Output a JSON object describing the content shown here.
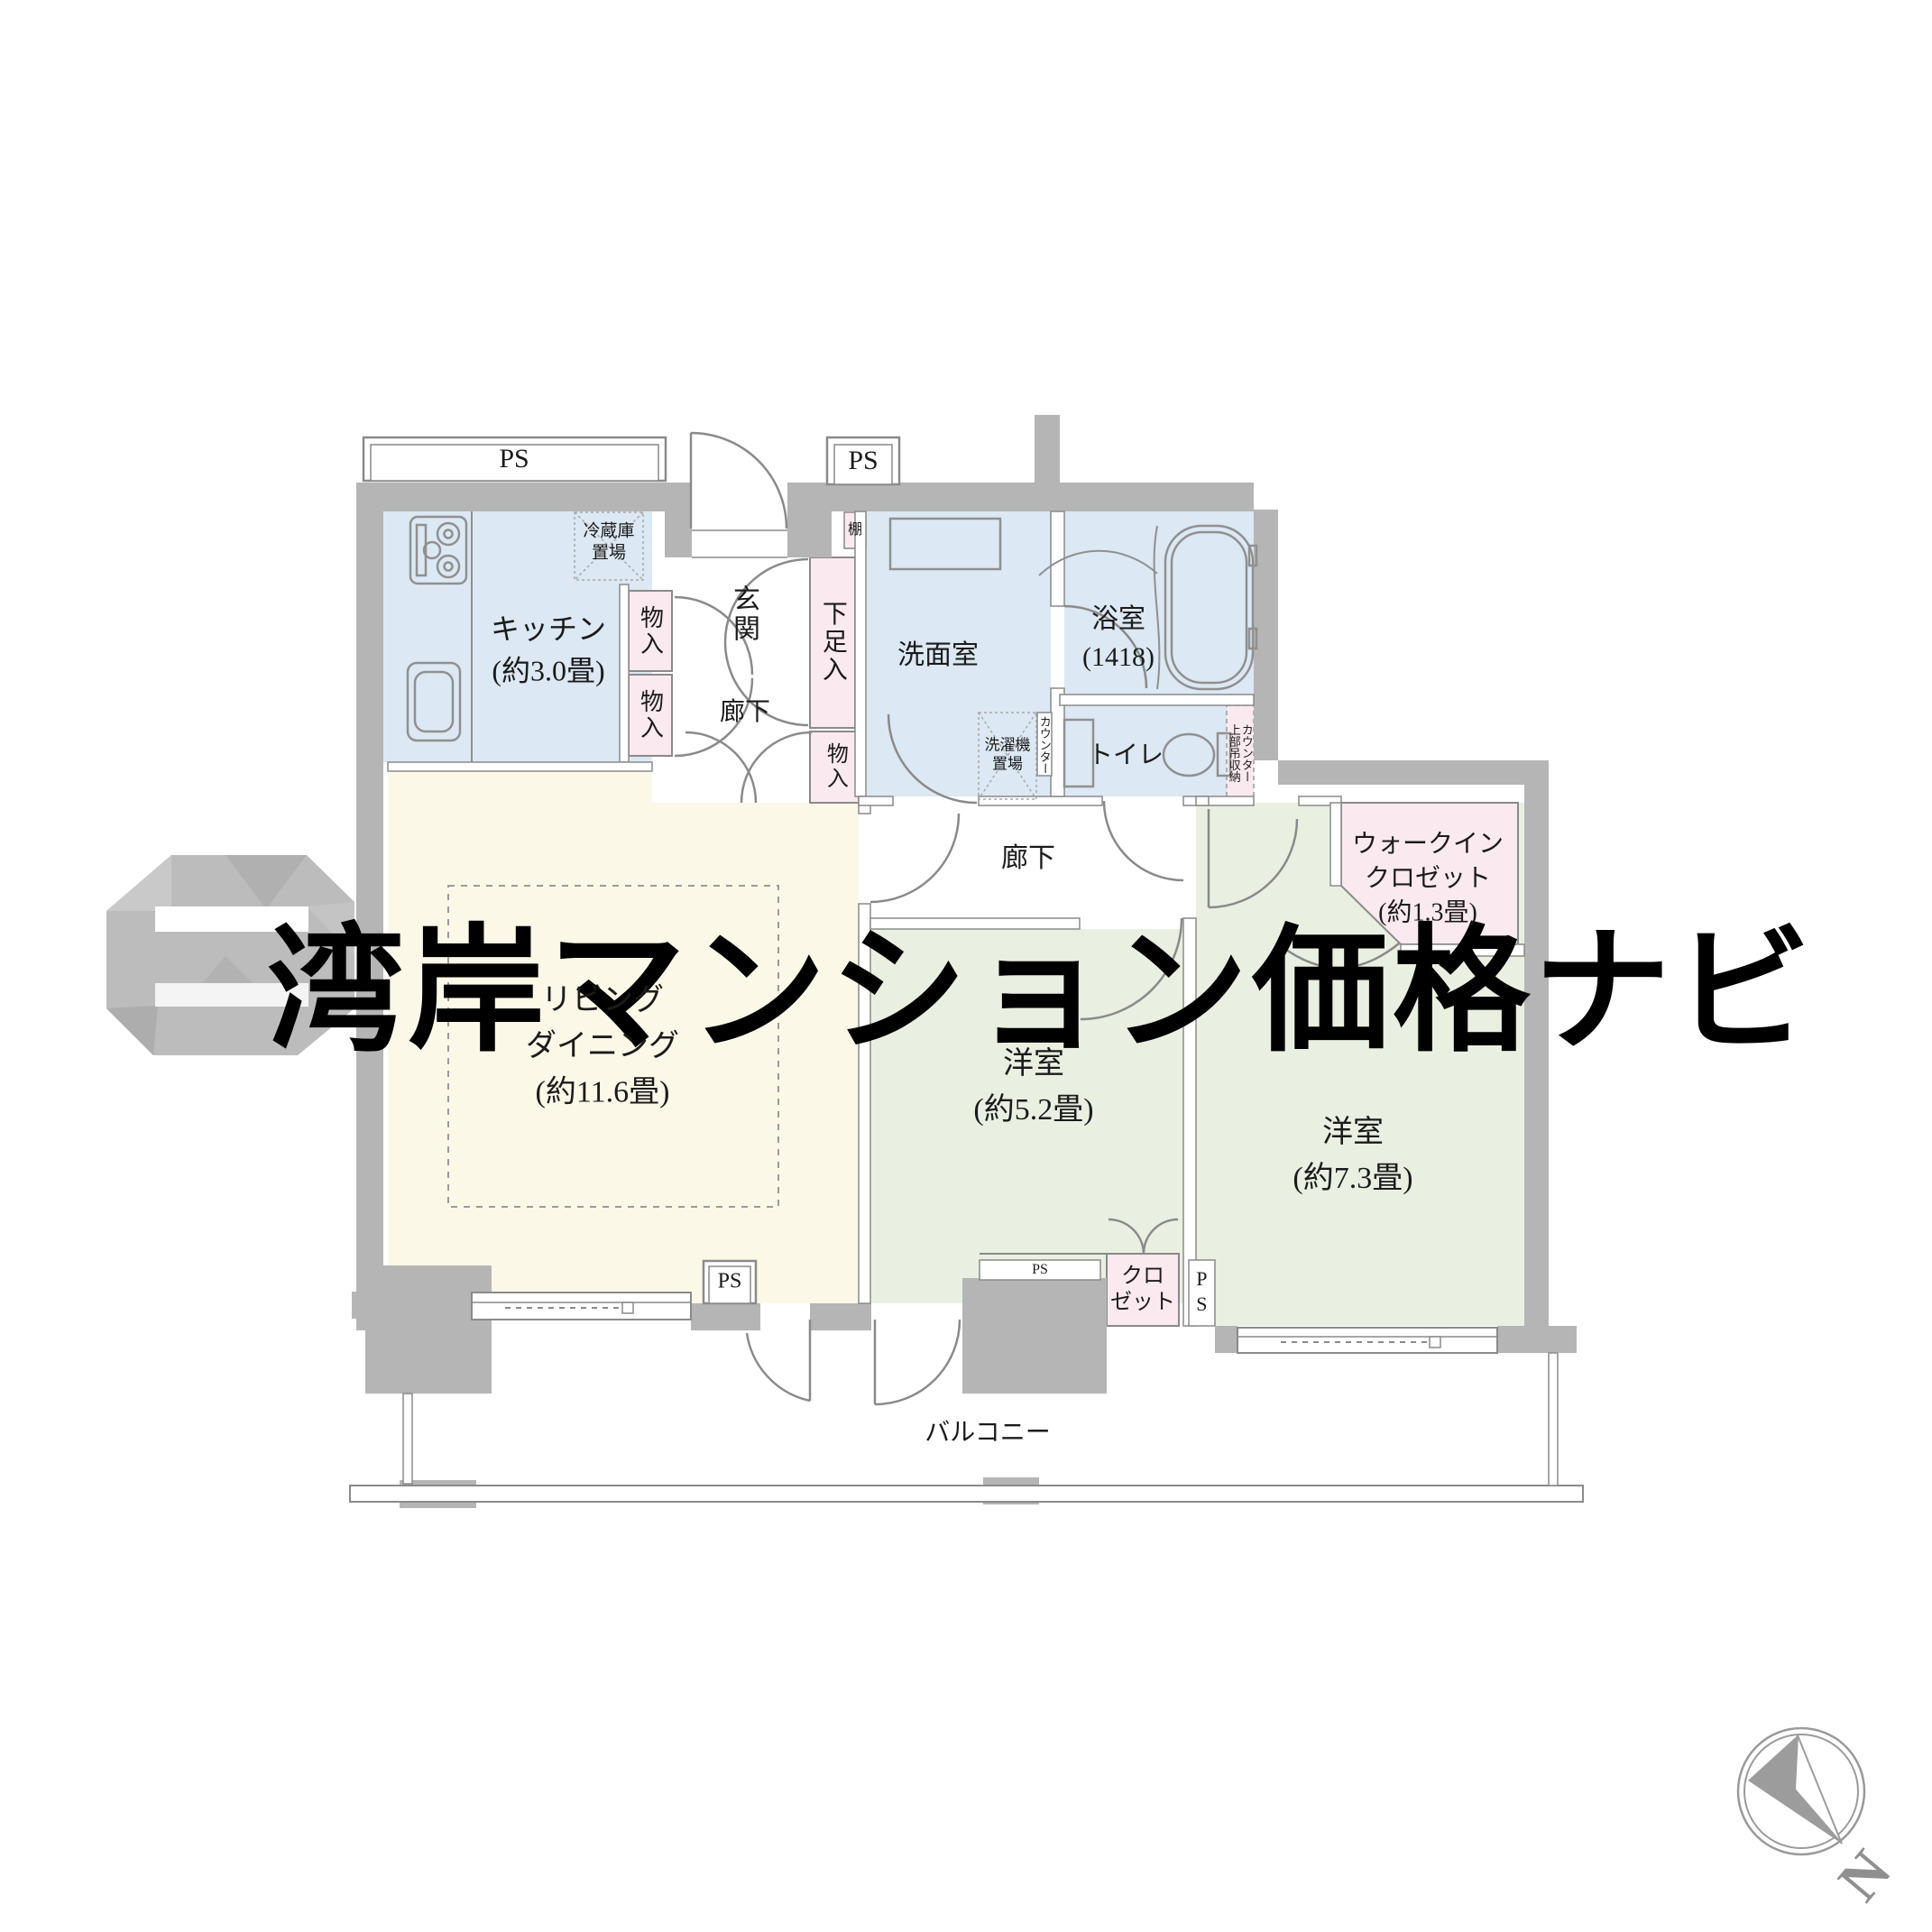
{
  "watermark": {
    "text": "湾岸マンション価格ナビ"
  },
  "compass": {
    "north_label": "N"
  },
  "colors": {
    "wall": "#b5b5b5",
    "wet_room": "#dce8f3",
    "living": "#fcf8e8",
    "bedroom": "#e9f0e2",
    "storage_pink": "#fae9ef",
    "line": "#8a8a8a"
  },
  "rooms": {
    "kitchen": {
      "name": "キッチン",
      "size": "(約3.0畳)"
    },
    "living": {
      "name_line1": "リビング",
      "name_line2": "ダイニング",
      "size": "(約11.6畳)"
    },
    "bedroom1": {
      "name": "洋室",
      "size": "(約5.2畳)"
    },
    "bedroom2": {
      "name": "洋室",
      "size": "(約7.3畳)"
    },
    "bath": {
      "name": "浴室",
      "size": "(1418)"
    },
    "washroom": {
      "name": "洗面室"
    },
    "toilet": {
      "name": "トイレ"
    },
    "entrance": {
      "name": "玄関"
    },
    "corridor1": {
      "name": "廊下"
    },
    "corridor2": {
      "name": "廊下"
    },
    "wic": {
      "line1": "ウォークイン",
      "line2": "クロゼット",
      "size": "(約1.3畳)"
    },
    "balcony": {
      "name": "バルコニー"
    }
  },
  "storage": {
    "monoire1": "物入",
    "monoire2": "物入",
    "monoire3": "物入",
    "shoe_box": "下足入",
    "shelf": "棚",
    "fridge_line1": "冷蔵庫",
    "fridge_line2": "置場",
    "washer_line1": "洗濯機",
    "washer_line2": "置場",
    "counter_washroom": "カウンター",
    "counter_toilet": "カウンター",
    "upper_storage": "上部吊収納",
    "closet_line1": "クロ",
    "closet_line2": "ゼット"
  },
  "ps": {
    "top_left": "PS",
    "top_center": "PS",
    "living": "PS",
    "bedroom1_h": "PS",
    "bedroom1_v": "PS"
  }
}
